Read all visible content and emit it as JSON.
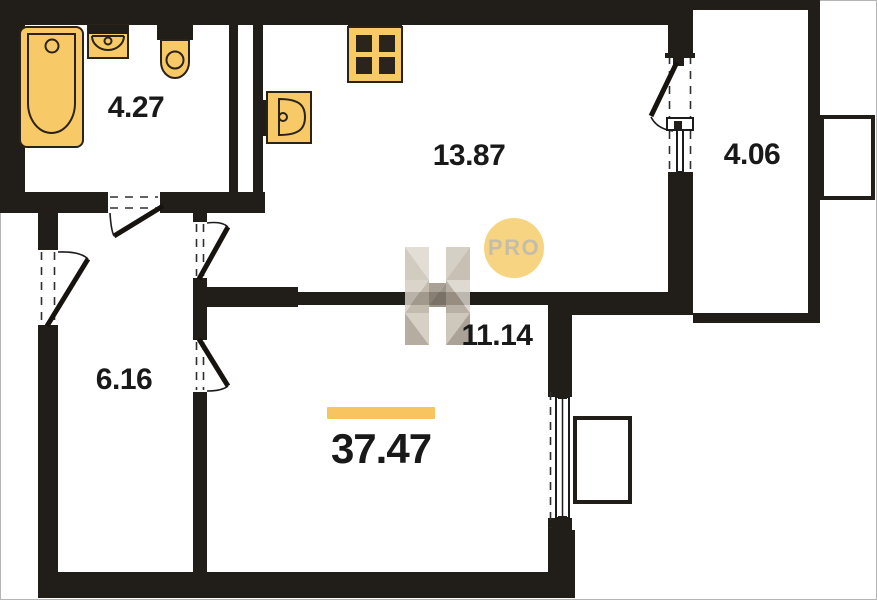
{
  "watermark": {
    "letter": "H",
    "badge": "PRO"
  },
  "rooms": {
    "bathroom": {
      "area": "4.27"
    },
    "kitchen": {
      "area": "13.87"
    },
    "balcony": {
      "area": "4.06"
    },
    "hallway": {
      "area": "6.16"
    },
    "living": {
      "area": "11.14"
    }
  },
  "total": {
    "area": "37.47"
  },
  "colors": {
    "wall": "#211d18",
    "accent": "#f7c45f",
    "fixture": "#f8c967",
    "fixture-line": "#2b2317",
    "badge-bg": "#f6d37c",
    "badge-text": "#c3baa6",
    "label": "#191919",
    "dash": "#2f2f2f"
  },
  "icons": {
    "fixtures": [
      "bathtub-icon",
      "washbasin-icon",
      "toilet-icon",
      "kitchen-sink-icon",
      "stove-icon"
    ],
    "badge": "pro-badge"
  }
}
